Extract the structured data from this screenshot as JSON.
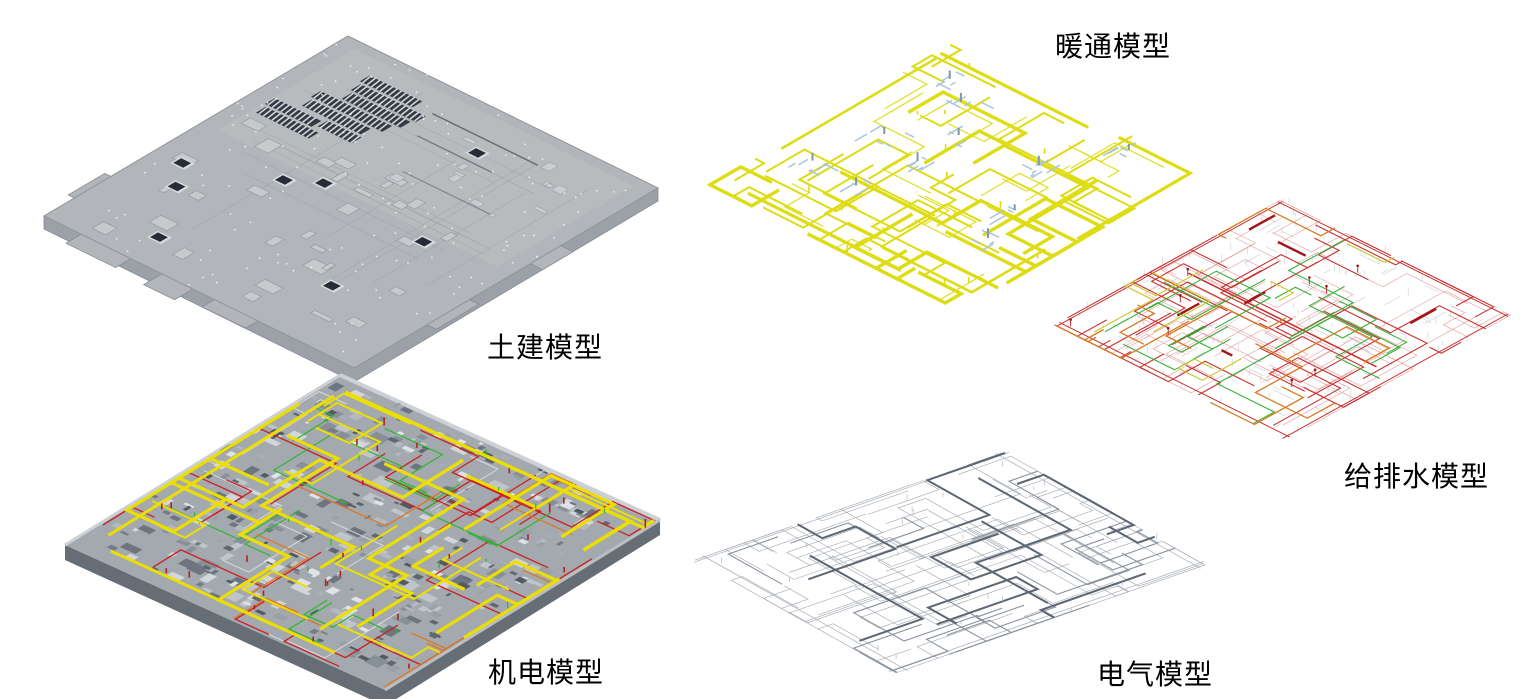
{
  "figure": {
    "background": "#ffffff",
    "panels": [
      {
        "id": "civil",
        "label": "土建模型",
        "colors": {
          "slab": "#b2b6ba",
          "slab_light": "#c6cacd",
          "edge": "#868c93",
          "side": "#9ba1a7",
          "hole": "#262c35",
          "rib": "#d2d6da",
          "dot": "#eef0f2",
          "outline": "#8f959b",
          "hatch": "#3f454d"
        }
      },
      {
        "id": "mep",
        "label": "机电模型",
        "colors": {
          "base": "#a4a9af",
          "duct": "#ecdf00",
          "pipe_red": "#cc2020",
          "pipe_green": "#2db82d",
          "pipe_orange": "#dd7722",
          "pipe_light": "#dde0e3",
          "edge": "#666d75",
          "parapet": "#cdd1d5"
        }
      },
      {
        "id": "hvac",
        "label": "暖通模型",
        "colors": {
          "duct": "#dedc12",
          "fitting": "#a9c5db",
          "fitting_dark": "#7f97ab"
        }
      },
      {
        "id": "plumbing",
        "label": "给排水模型",
        "colors": {
          "red": "#c83030",
          "light_red": "#e09494",
          "dark_red": "#a31515",
          "green": "#38b038",
          "orange": "#d97820",
          "yellow": "#c6c622",
          "gray": "#c3c7cb"
        }
      },
      {
        "id": "electrical",
        "label": "电气模型",
        "colors": {
          "line": "#a6adb4",
          "mid": "#8a939c",
          "trunk": "#5d6773"
        }
      }
    ]
  }
}
